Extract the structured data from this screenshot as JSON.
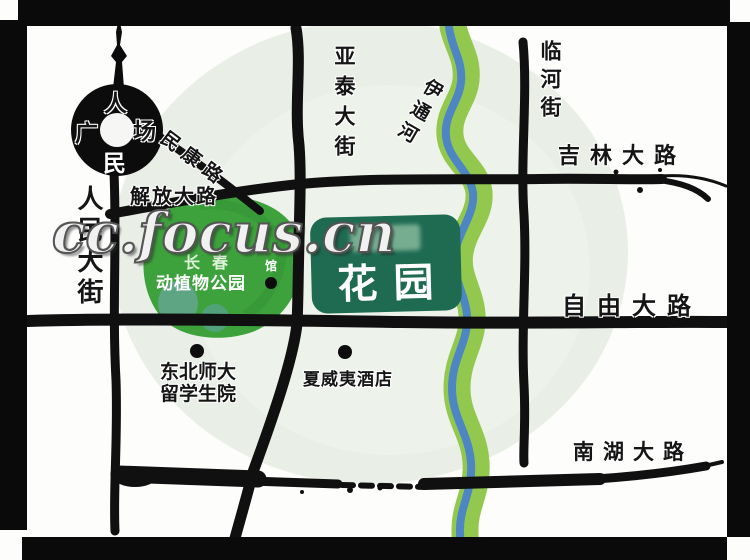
{
  "map": {
    "watermark": "cc.focus.cn",
    "square": {
      "char_top": "人",
      "char_left": "广",
      "char_right": "场",
      "char_bottom": "民"
    },
    "streets": {
      "renmin_dajie": "人民大街",
      "jiefang_dalu": "解放大路",
      "minkang_lu": "民康路",
      "yatai_dajie": "亚泰大街",
      "linhe_jie": "临河街",
      "jilin_dalu": "吉林大路",
      "ziyou_dalu": "自由大路",
      "nanhu_dalu": "南湖大路"
    },
    "river": {
      "name": "伊通河"
    },
    "park": {
      "city": "长春",
      "name": "动植物公园"
    },
    "project": {
      "name_visible": "花园"
    },
    "pois": {
      "university_line1": "东北师大",
      "university_line2": "留学生院",
      "hotel": "夏威夷酒店",
      "hall": "馆"
    },
    "colors": {
      "road": "#111111",
      "park_green": "#3da23c",
      "project_green": "#1e6b52",
      "river_green": "#93c84e",
      "river_blue": "#4e86c4",
      "tint_circle": "#e9efe7",
      "frame": "#000000"
    }
  }
}
